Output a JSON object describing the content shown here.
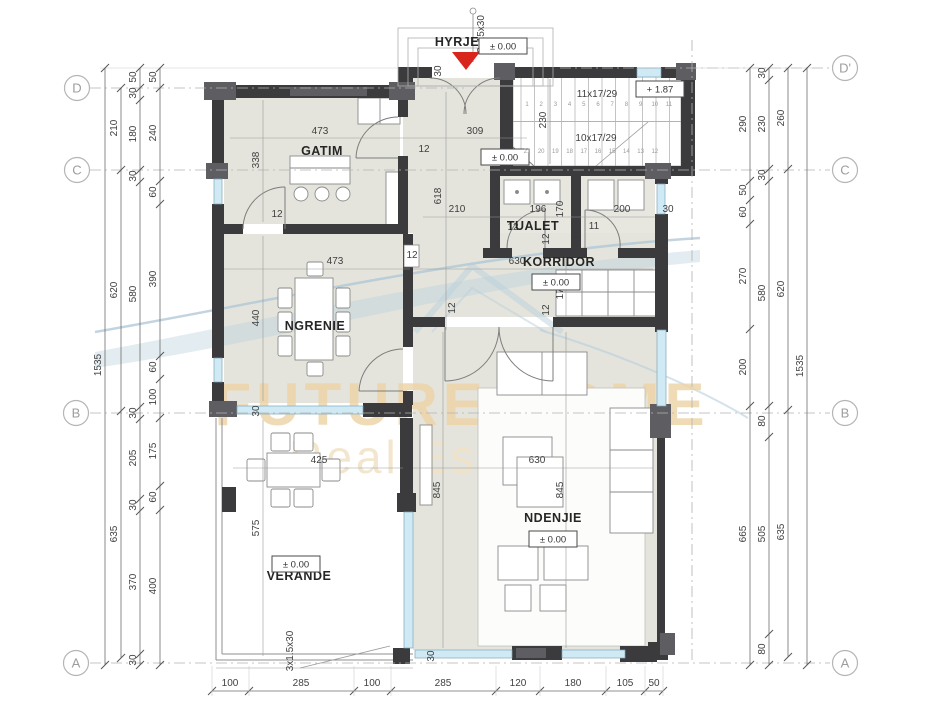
{
  "watermark": {
    "brand": "FUTURE HOME",
    "tagline": "Real Estate"
  },
  "colors": {
    "wall": "#3b3b3d",
    "block": "#5e5e62",
    "room_fill": "#e4e4dc",
    "window": "#cfeaf4",
    "window_frame": "#7fa8ba",
    "red_marker": "#d9261c",
    "watermark_tan": "#edd3a6",
    "watermark_blue": "#aec6d6",
    "dim_text": "#3f3f3f"
  },
  "grid_bubbles": [
    {
      "letter": "D",
      "x": 77,
      "y": 88
    },
    {
      "letter": "C",
      "x": 77,
      "y": 170
    },
    {
      "letter": "B",
      "x": 76,
      "y": 413
    },
    {
      "letter": "A",
      "x": 76,
      "y": 663
    },
    {
      "letter": "D'",
      "x": 845,
      "y": 68
    },
    {
      "letter": "C",
      "x": 845,
      "y": 170
    },
    {
      "letter": "B",
      "x": 845,
      "y": 413
    },
    {
      "letter": "A",
      "x": 845,
      "y": 663
    }
  ],
  "rooms": [
    {
      "name": "HYRJE",
      "x": 457,
      "y": 46
    },
    {
      "name": "GATIM",
      "x": 322,
      "y": 155
    },
    {
      "name": "NGRENIE",
      "x": 315,
      "y": 330
    },
    {
      "name": "TUALET",
      "x": 533,
      "y": 230
    },
    {
      "name": "KORRIDOR",
      "x": 559,
      "y": 266
    },
    {
      "name": "NDENJIE",
      "x": 553,
      "y": 522
    },
    {
      "name": "VERANDE",
      "x": 299,
      "y": 580
    }
  ],
  "level_badges": [
    {
      "t": "± 0.00",
      "x": 503,
      "y": 46
    },
    {
      "t": "± 0.00",
      "x": 505,
      "y": 157
    },
    {
      "t": "± 0.00",
      "x": 556,
      "y": 282
    },
    {
      "t": "± 0.00",
      "x": 553,
      "y": 539
    },
    {
      "t": "± 0.00",
      "x": 296,
      "y": 564
    },
    {
      "t": "+ 1.87",
      "x": 660,
      "y": 89
    }
  ],
  "plan_dimensions": [
    {
      "t": "473",
      "x": 320,
      "y": 134
    },
    {
      "t": "309",
      "x": 475,
      "y": 134
    },
    {
      "t": "338",
      "x": 259,
      "y": 160,
      "v": 1
    },
    {
      "t": "618",
      "x": 441,
      "y": 196,
      "v": 1
    },
    {
      "t": "210",
      "x": 457,
      "y": 212
    },
    {
      "t": "473",
      "x": 335,
      "y": 264
    },
    {
      "t": "440",
      "x": 259,
      "y": 318,
      "v": 1
    },
    {
      "t": "196",
      "x": 538,
      "y": 212
    },
    {
      "t": "170",
      "x": 563,
      "y": 209,
      "v": 1
    },
    {
      "t": "200",
      "x": 622,
      "y": 212
    },
    {
      "t": "30",
      "x": 668,
      "y": 212
    },
    {
      "t": "630",
      "x": 517,
      "y": 264
    },
    {
      "t": "176",
      "x": 563,
      "y": 291,
      "v": 1
    },
    {
      "t": "630",
      "x": 537,
      "y": 463
    },
    {
      "t": "845",
      "x": 440,
      "y": 490,
      "v": 1
    },
    {
      "t": "845",
      "x": 563,
      "y": 490,
      "v": 1
    },
    {
      "t": "425",
      "x": 319,
      "y": 463
    },
    {
      "t": "575",
      "x": 259,
      "y": 528,
      "v": 1
    },
    {
      "t": "230",
      "x": 546,
      "y": 120,
      "v": 1
    },
    {
      "t": "11x17/29",
      "x": 597,
      "y": 97
    },
    {
      "t": "10x17/29",
      "x": 596,
      "y": 141
    },
    {
      "t": "3x15x30",
      "x": 484,
      "y": 34,
      "v": 1
    },
    {
      "t": "3x1.5x30",
      "x": 293,
      "y": 651,
      "v": 1
    },
    {
      "t": "30",
      "x": 441,
      "y": 71,
      "v": 1
    },
    {
      "t": "30",
      "x": 434,
      "y": 656,
      "v": 1
    },
    {
      "t": "30",
      "x": 259,
      "y": 411,
      "v": 1
    },
    {
      "t": "12",
      "x": 424,
      "y": 152
    },
    {
      "t": "12",
      "x": 277,
      "y": 217
    },
    {
      "t": "12",
      "x": 412,
      "y": 258
    },
    {
      "t": "12",
      "x": 455,
      "y": 308,
      "v": 1
    },
    {
      "t": "12",
      "x": 513,
      "y": 230
    },
    {
      "t": "11",
      "x": 594,
      "y": 229
    },
    {
      "t": "12",
      "x": 549,
      "y": 239,
      "v": 1
    },
    {
      "t": "12",
      "x": 549,
      "y": 310,
      "v": 1
    }
  ],
  "stairs": {
    "upper_flight_label": "11x17/29",
    "lower_flight_label": "10x17/29",
    "upper_steps": [
      "1",
      "2",
      "3",
      "4",
      "5",
      "6",
      "7",
      "8",
      "9",
      "10",
      "11"
    ],
    "lower_steps": [
      "21",
      "20",
      "19",
      "18",
      "17",
      "16",
      "15",
      "14",
      "13",
      "12"
    ]
  },
  "dimension_chains": [
    {
      "orient": "v",
      "pos": 105,
      "ticks": [
        68,
        665
      ],
      "labels": [
        {
          "t": "1535",
          "at": 365
        }
      ]
    },
    {
      "orient": "v",
      "pos": 121,
      "ticks": [
        88,
        170,
        411,
        658
      ],
      "labels": [
        {
          "t": "210",
          "at": 128
        },
        {
          "t": "620",
          "at": 290
        },
        {
          "t": "635",
          "at": 534
        }
      ]
    },
    {
      "orient": "v",
      "pos": 140,
      "ticks": [
        68,
        88,
        100,
        170,
        182,
        407,
        419,
        499,
        511,
        654,
        665
      ],
      "labels": [
        {
          "t": "50",
          "at": 77
        },
        {
          "t": "30",
          "at": 93
        },
        {
          "t": "180",
          "at": 134
        },
        {
          "t": "30",
          "at": 176
        },
        {
          "t": "580",
          "at": 294
        },
        {
          "t": "30",
          "at": 413
        },
        {
          "t": "205",
          "at": 458
        },
        {
          "t": "30",
          "at": 505
        },
        {
          "t": "370",
          "at": 582
        },
        {
          "t": "30",
          "at": 660
        }
      ]
    },
    {
      "orient": "v",
      "pos": 160,
      "ticks": [
        68,
        88,
        181,
        204,
        356,
        379,
        418,
        486,
        510,
        665
      ],
      "labels": [
        {
          "t": "50",
          "at": 77
        },
        {
          "t": "240",
          "at": 133
        },
        {
          "t": "60",
          "at": 192
        },
        {
          "t": "390",
          "at": 279
        },
        {
          "t": "60",
          "at": 367
        },
        {
          "t": "100",
          "at": 397
        },
        {
          "t": "175",
          "at": 451
        },
        {
          "t": "60",
          "at": 497
        },
        {
          "t": "400",
          "at": 586
        }
      ]
    },
    {
      "orient": "v",
      "pos": 750,
      "ticks": [
        68,
        181,
        200,
        224,
        329,
        406,
        665
      ],
      "labels": [
        {
          "t": "290",
          "at": 124
        },
        {
          "t": "50",
          "at": 190
        },
        {
          "t": "60",
          "at": 212
        },
        {
          "t": "270",
          "at": 276
        },
        {
          "t": "200",
          "at": 367
        },
        {
          "t": "665",
          "at": 534
        }
      ]
    },
    {
      "orient": "v",
      "pos": 769,
      "ticks": [
        68,
        80,
        169,
        181,
        406,
        437,
        634,
        665
      ],
      "labels": [
        {
          "t": "30",
          "at": 73
        },
        {
          "t": "230",
          "at": 124
        },
        {
          "t": "30",
          "at": 175
        },
        {
          "t": "580",
          "at": 293
        },
        {
          "t": "80",
          "at": 421
        },
        {
          "t": "505",
          "at": 534
        },
        {
          "t": "80",
          "at": 649
        }
      ]
    },
    {
      "orient": "v",
      "pos": 788,
      "ticks": [
        68,
        169,
        410,
        657
      ],
      "labels": [
        {
          "t": "260",
          "at": 118
        },
        {
          "t": "620",
          "at": 289
        },
        {
          "t": "635",
          "at": 532
        }
      ]
    },
    {
      "orient": "v",
      "pos": 807,
      "ticks": [
        68,
        665
      ],
      "labels": [
        {
          "t": "1535",
          "at": 366
        }
      ]
    },
    {
      "orient": "h",
      "pos": 691,
      "ticks": [
        212,
        249,
        354,
        391,
        496,
        540,
        606,
        645,
        663
      ],
      "labels": [
        {
          "t": "100",
          "at": 230
        },
        {
          "t": "285",
          "at": 301
        },
        {
          "t": "100",
          "at": 372
        },
        {
          "t": "285",
          "at": 443
        },
        {
          "t": "120",
          "at": 518
        },
        {
          "t": "180",
          "at": 573
        },
        {
          "t": "105",
          "at": 625
        },
        {
          "t": "50",
          "at": 654
        }
      ]
    }
  ]
}
